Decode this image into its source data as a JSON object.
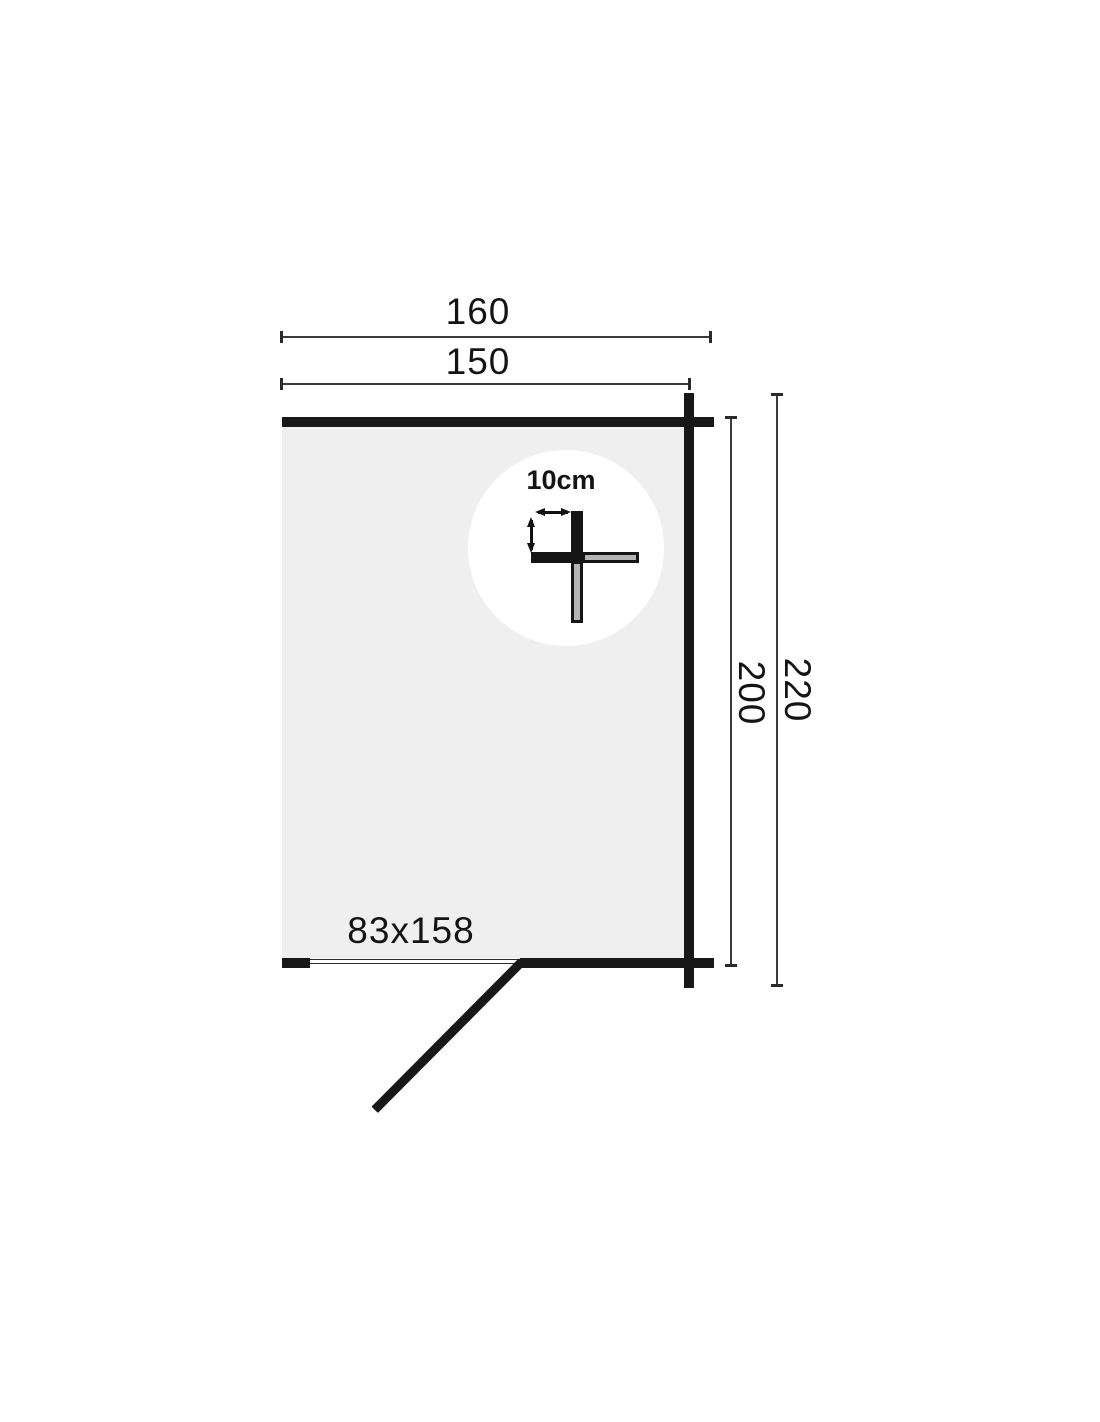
{
  "diagram": {
    "type": "log-cabin-floor-plan",
    "unit": "cm",
    "dimensions": {
      "top_outer_width": "160",
      "top_inner_width": "150",
      "right_inner_depth": "200",
      "right_outer_depth": "220"
    },
    "door": {
      "size_label": "83x158"
    },
    "wall_detail": {
      "thickness_label": "10cm"
    },
    "colors": {
      "wall": "#181818",
      "floor": "#efefef",
      "dimension_line": "#3a3a3a",
      "log_core_fill": "#b4b4b4",
      "background": "#ffffff"
    }
  }
}
